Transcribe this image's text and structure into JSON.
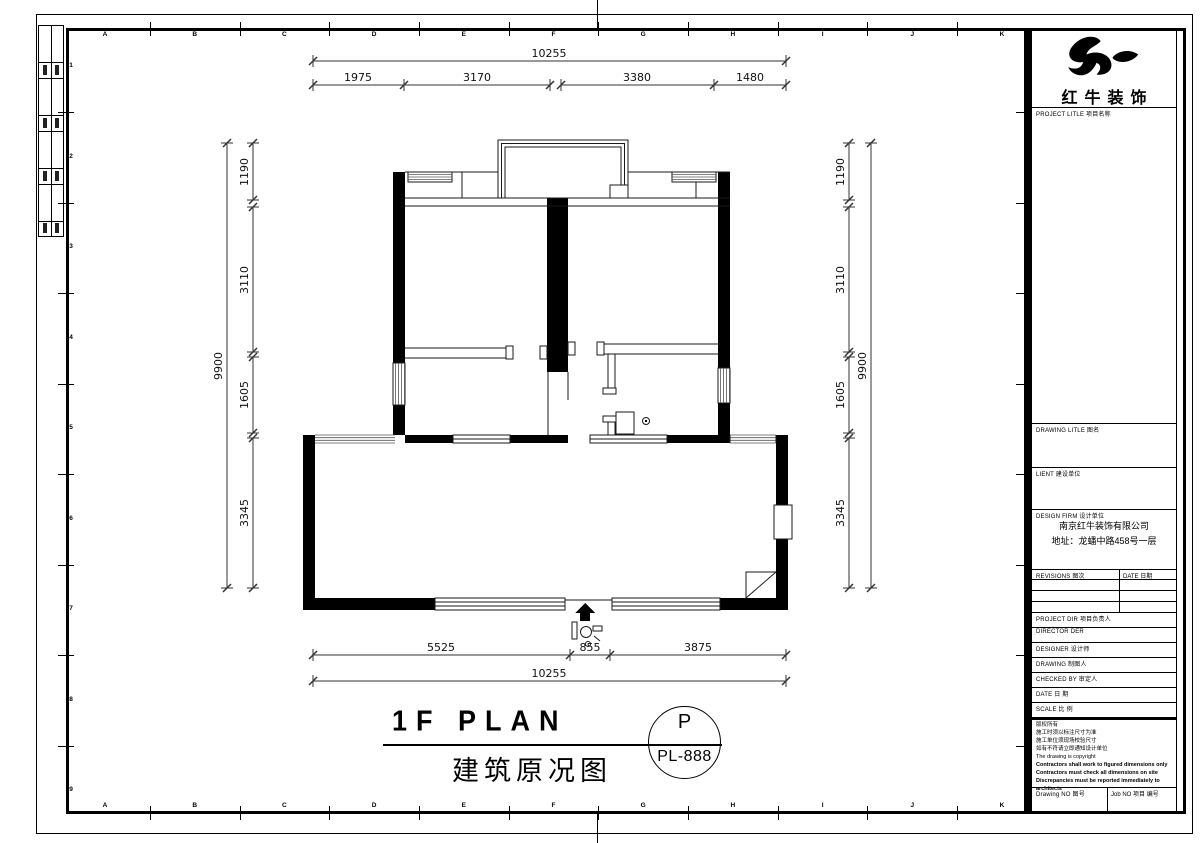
{
  "sheet": {
    "grid_letters": [
      "A",
      "B",
      "C",
      "D",
      "E",
      "F",
      "G",
      "H",
      "I",
      "J",
      "K"
    ],
    "grid_numbers": [
      "1",
      "2",
      "3",
      "4",
      "5",
      "6",
      "7",
      "8",
      "9"
    ]
  },
  "plan": {
    "dims_top": {
      "total": "10255",
      "segments": [
        "1975",
        "3170",
        "3380",
        "1480"
      ]
    },
    "dims_left": {
      "total": "9900",
      "segments": [
        "1190",
        "3110",
        "1605",
        "3345"
      ]
    },
    "dims_right": {
      "total": "9900",
      "segments": [
        "1190",
        "3110",
        "1605",
        "3345"
      ]
    },
    "dims_bottom": {
      "total": "10255",
      "segments": [
        "5525",
        "855",
        "3875"
      ]
    }
  },
  "title": {
    "plan_name_en": "1F PLAN",
    "plan_name_cn": "建筑原况图",
    "stamp_letter": "P",
    "stamp_number": "PL-888"
  },
  "titleblock": {
    "brand_name": "红牛装饰",
    "project_title_label": "PROJECT LITLE  项目名称",
    "drawing_title_label": "DRAWING LITLE  图名",
    "client_label": "LIENT  建设单位",
    "design_firm_label": "DESIGN FIRM  设计单位",
    "firm_name": "南京红牛装饰有限公司",
    "firm_address": "地址：龙蟠中路458号一层",
    "revisions_label": "REVISIONS  图次",
    "revision_date_label": "DATE  日期",
    "project_dir_label": "PROJECT DIR  项目负责人",
    "director_label": "DIRECTOR DER",
    "designer_label": "DESIGNER  设计师",
    "drawing_by_label": "DRAWING  制图人",
    "checked_by_label": "CHECKED BY  审定人",
    "date_label": "DATE  日 期",
    "scale_label": "SCALE  比 例",
    "notes": [
      "版权所有",
      "施工时须以标注尺寸为准",
      "施工单位须现场校验尺寸",
      "如有不符请立即通知设计单位",
      "The drawing is copyright",
      "Contractors shall work to figured dimensions only",
      "Contractors must check all dimensions on site",
      "Discrepancies must be reported immediately to architects"
    ],
    "drawing_no_label": "Drawing NO  图号",
    "job_no_label": "Job NO  项目 编号"
  }
}
